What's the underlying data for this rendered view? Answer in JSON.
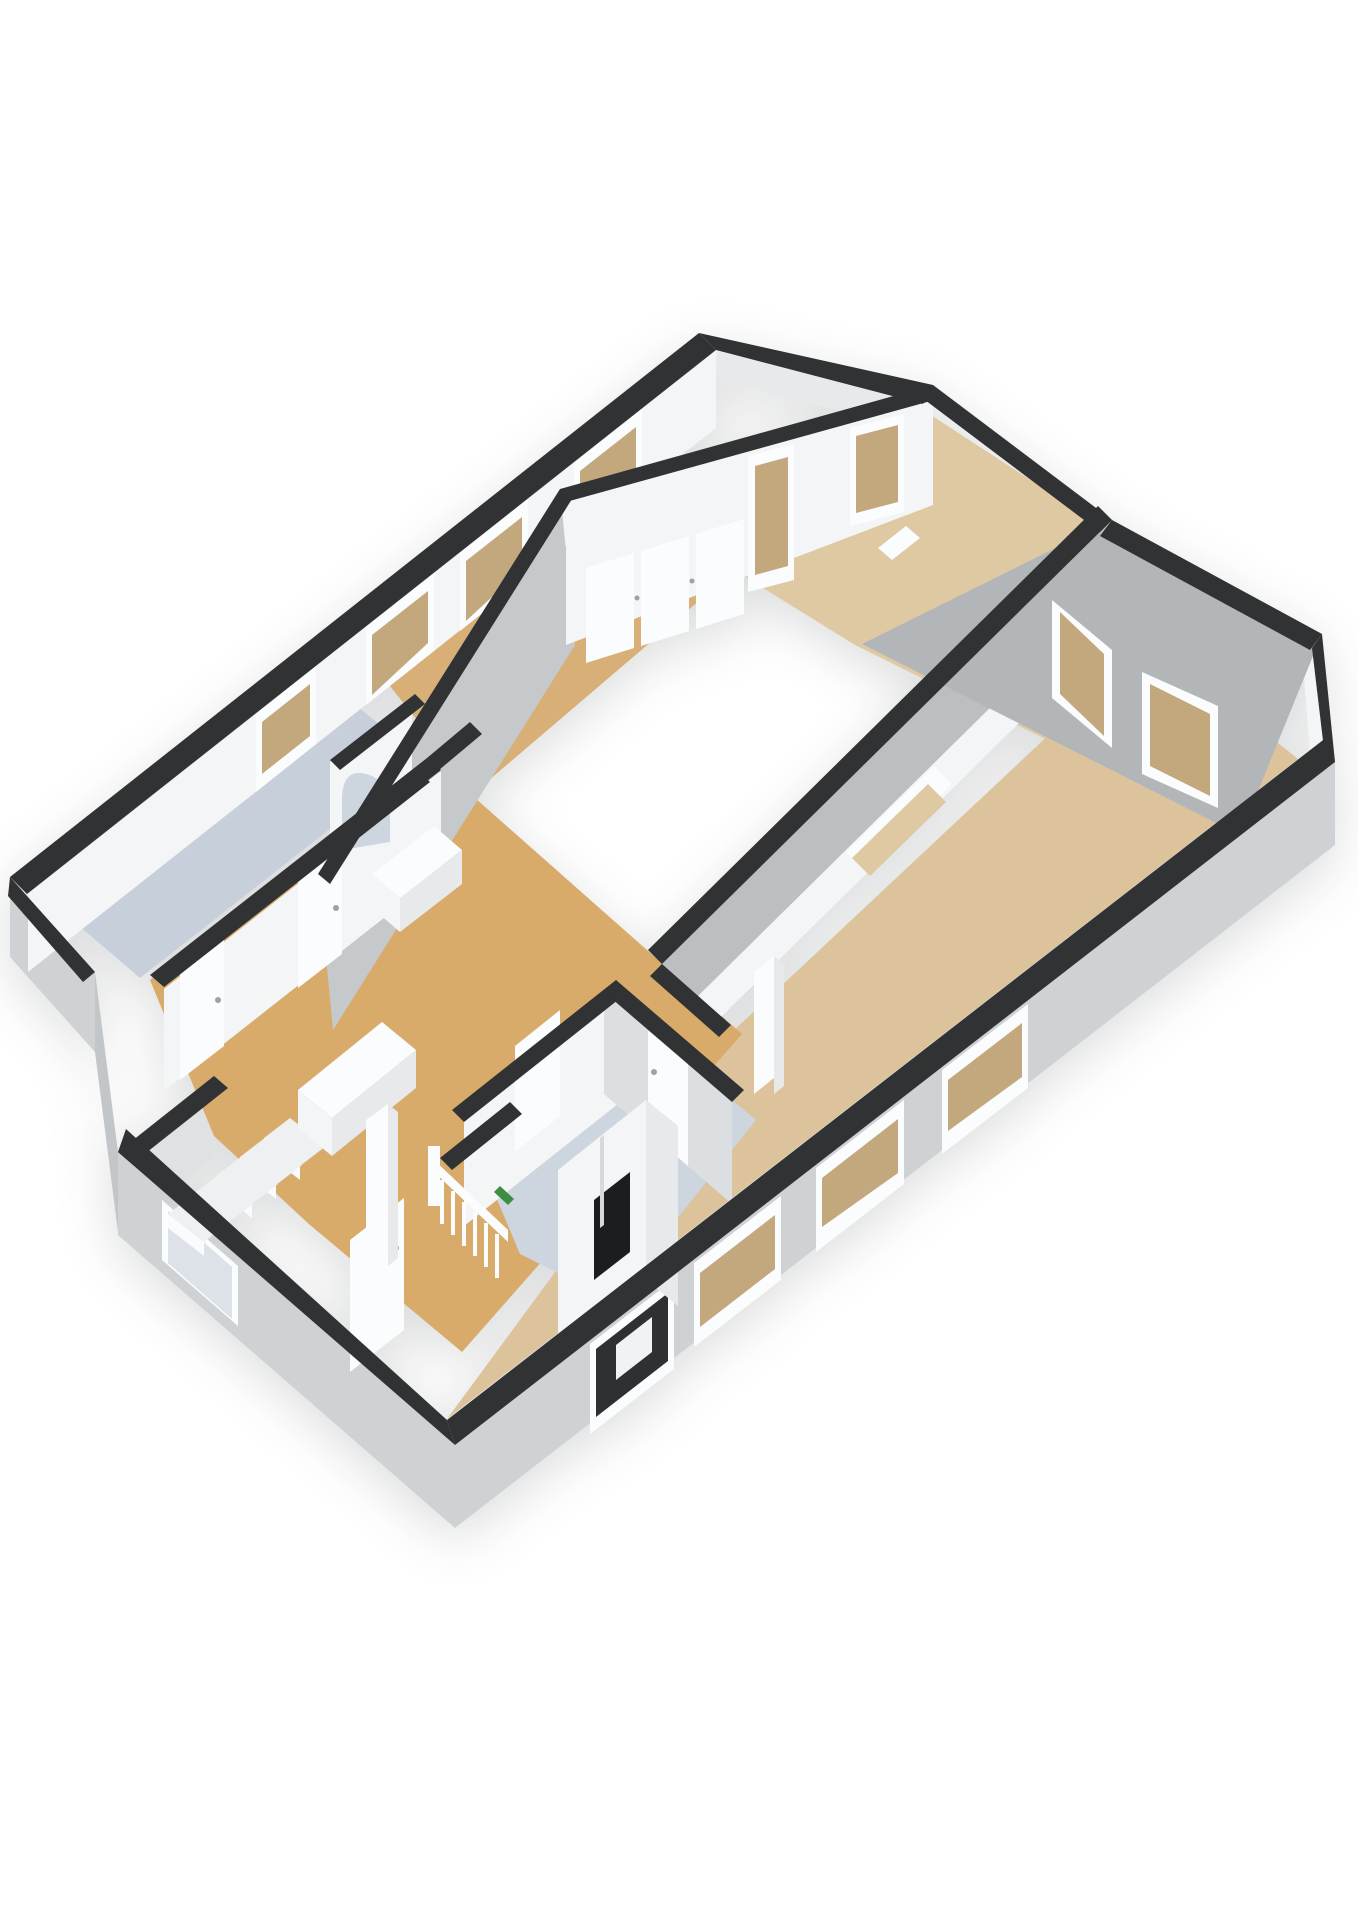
{
  "scene": {
    "kind": "3d-floorplan-isometric-render",
    "background": "#ffffff",
    "storey": "attic-floor",
    "visible_text": []
  },
  "palette": {
    "cap": "#303234",
    "wallWhite": "#f3f5f6",
    "wallDim": "#e7e9eb",
    "wallShade": "#dcdfe1",
    "ext": "#cfd2d4",
    "extDark": "#c3c6c8",
    "extLight": "#dfe1e3",
    "roofGray": "#b3b6b9",
    "roofGray2": "#bcbfc2",
    "centerWall": "#c6c9cc",
    "floorBeige": "#dfc9a3",
    "floorBeige2": "#dcc39b",
    "floorTan": "#d8b077",
    "floorOchre": "#d9ab6a",
    "floorBlue": "#c7cfda",
    "floorBlue2": "#cdd5df",
    "glassTan": "#c2a87c",
    "glassGray": "#dce2e8",
    "glassDark": "#2e3032",
    "white": "#fbfcfd",
    "seam": "#d7dadc",
    "green": "#3e8e41",
    "panelDark": "#1b1d1f",
    "boiler": "#f1f2f3"
  },
  "rooms": [
    {
      "id": "attic-room-rear",
      "floor": "floorBeige",
      "features": [
        "roof-slope",
        "two-roof-windows",
        "closet-wall",
        "glazed-door"
      ]
    },
    {
      "id": "bedroom-front-large",
      "floor": "floorBeige2",
      "features": [
        "three-facade-windows",
        "knee-wall-openings"
      ]
    },
    {
      "id": "bedroom-middle",
      "floor": "floorTan",
      "features": [
        "two-windows"
      ]
    },
    {
      "id": "bathroom-long",
      "floor": "floorBlue",
      "features": [
        "window",
        "two-doors"
      ]
    },
    {
      "id": "landing",
      "floor": "floorOchre",
      "features": [
        "staircase",
        "railing",
        "pillars",
        "arched-doorway"
      ]
    },
    {
      "id": "utility-room",
      "floor": "floorBlue2",
      "features": [
        "wardrobe",
        "boiler-window"
      ]
    }
  ],
  "windows": {
    "nw_wall_count": 4,
    "se_wall_count": 3,
    "roof_slope_count": 2,
    "bump_out_count": 1,
    "utility_dark_window_count": 1
  },
  "furniture": [
    {
      "id": "wardrobe-with-dark-panel"
    },
    {
      "id": "staircase-steps",
      "steps": 5
    },
    {
      "id": "stair-railing",
      "balusters": 6
    },
    {
      "id": "chimney-pillar"
    },
    {
      "id": "low-cabinet"
    },
    {
      "id": "shelf-unit"
    },
    {
      "id": "boiler-unit"
    }
  ]
}
